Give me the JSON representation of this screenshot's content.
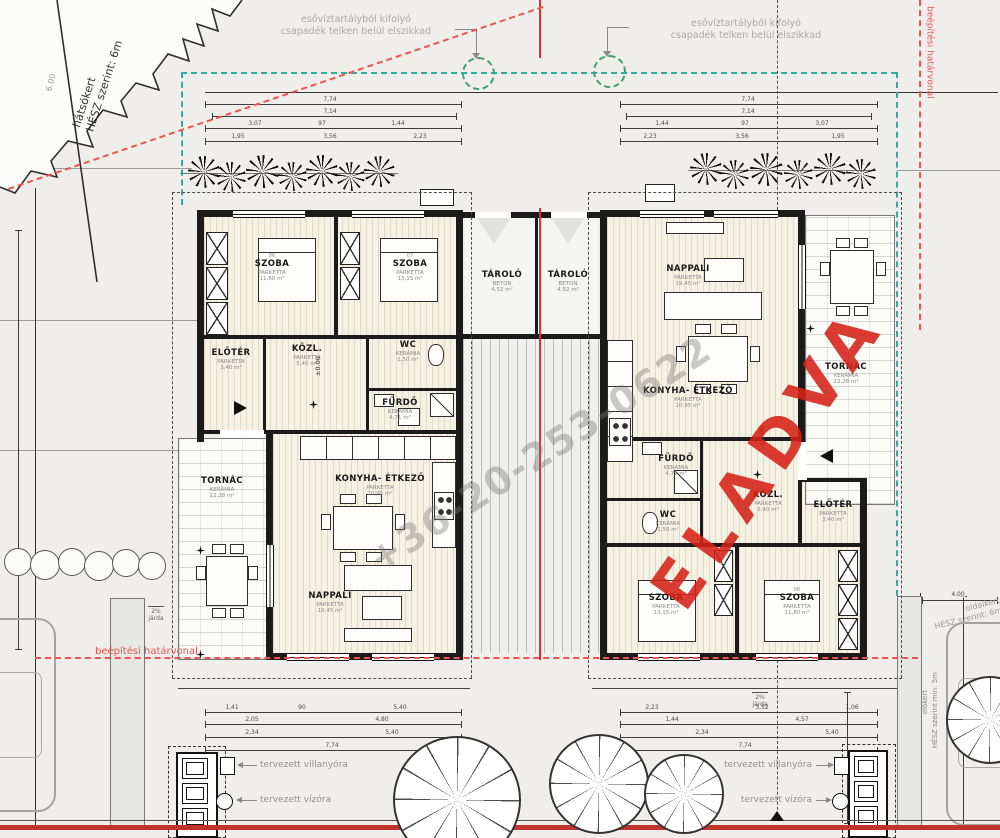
{
  "watermarks": {
    "sold": "ELADVA",
    "phone": "+36-20-253-0622"
  },
  "notes": {
    "rain1": "esővíztartályból kifolyó",
    "rain2": "csapadék telken belül elszikkad",
    "backyard1": "hátsókert",
    "backyard2": "HÉSZ szerint: 6m",
    "backyard_dim": "6.00",
    "build_line": "beépítési határvonal",
    "sideyard1": "oldalkert",
    "sideyard2": "HÉSZ szerint: 6m",
    "frontyard1": "előkert",
    "frontyard2": "HÉSZ szerint min: 5m",
    "sidewalk1": "2%",
    "sidewalk2": "járda",
    "level": "±0.00",
    "side_dim": "4,00"
  },
  "legend": {
    "electric": "tervezett villanyóra",
    "water": "tervezett vízóra"
  },
  "storage": {
    "left": {
      "name": "TÁROLÓ",
      "floor": "BETON",
      "area": "4,52 m²"
    },
    "right": {
      "name": "TÁROLÓ",
      "floor": "BETON",
      "area": "4,52 m²"
    }
  },
  "houses": {
    "left": {
      "szoba_a": {
        "no": "06",
        "name": "SZOBA",
        "floor": "PARKETTA",
        "area": "11,80 m²"
      },
      "szoba_b": {
        "no": "07",
        "name": "SZOBA",
        "floor": "PARKETTA",
        "area": "13,15 m²"
      },
      "eloter": {
        "name": "ELŐTÉR",
        "floor": "PARKETTA",
        "area": "3,40 m²"
      },
      "kozl": {
        "name": "KÖZL.",
        "floor": "PARKETTA",
        "area": "5,40 m²"
      },
      "wc": {
        "name": "WC",
        "floor": "KERÁMIA",
        "area": "1,50 m²"
      },
      "furdo": {
        "name": "FÜRDŐ",
        "floor": "KERÁMIA",
        "area": "4,71 m²"
      },
      "konyha": {
        "name": "KONYHA- ÉTKEZŐ",
        "floor": "PARKETTA",
        "area": "10,95 m²"
      },
      "nappali": {
        "name": "NAPPALI",
        "floor": "PARKETTA",
        "area": "19,45 m²"
      },
      "tornac": {
        "name": "TORNÁC",
        "floor": "KERÁMIA",
        "area": "22,28 m²"
      }
    },
    "right": {
      "szoba_a": {
        "no": "07",
        "name": "SZOBA",
        "floor": "PARKETTA",
        "area": "13,15 m²"
      },
      "szoba_b": {
        "no": "06",
        "name": "SZOBA",
        "floor": "PARKETTA",
        "area": "11,80 m²"
      },
      "eloter": {
        "name": "ELŐTÉR",
        "floor": "PARKETTA",
        "area": "3,40 m²"
      },
      "kozl": {
        "name": "KÖZL.",
        "floor": "PARKETTA",
        "area": "5,40 m²"
      },
      "wc": {
        "name": "WC",
        "floor": "KERÁMIA",
        "area": "1,50 m²"
      },
      "furdo": {
        "name": "FÜRDŐ",
        "floor": "KERÁMIA",
        "area": "4,71 m²"
      },
      "konyha": {
        "name": "KONYHA- ÉTKEZŐ",
        "floor": "PARKETTA",
        "area": "10,95 m²"
      },
      "nappali": {
        "name": "NAPPALI",
        "floor": "PARKETTA",
        "area": "19,45 m²"
      },
      "tornac": {
        "name": "TORNÁC",
        "floor": "KERÁMIA",
        "area": "22,28 m²"
      }
    }
  },
  "dims": {
    "lt1": "7,74",
    "lt2": "7,14",
    "lt3a": "3,07",
    "lt3b": "97",
    "lt3c": "1,44",
    "lt4a": "1,95",
    "lt4b": "3,56",
    "lt4c": "2,23",
    "rt1": "7,74",
    "rt2": "7,14",
    "rt3a": "1,44",
    "rt3b": "97",
    "rt3c": "3,07",
    "rt4a": "2,23",
    "rt4b": "3,56",
    "rt4c": "1,95",
    "lb1a": "1,41",
    "lb1b": "90",
    "lb1c": "5,40",
    "lb2a": "2,05",
    "lb2b": "4,80",
    "lb3a": "2,34",
    "lb3b": "5,40",
    "lb4": "7,74",
    "rb1a": "2,23",
    "rb1b": "3,52",
    "rb1c": "1,06",
    "rb2a": "1,44",
    "rb2b": "4,57",
    "rb3a": "2,34",
    "rb3b": "5,40",
    "rb4": "7,74"
  }
}
